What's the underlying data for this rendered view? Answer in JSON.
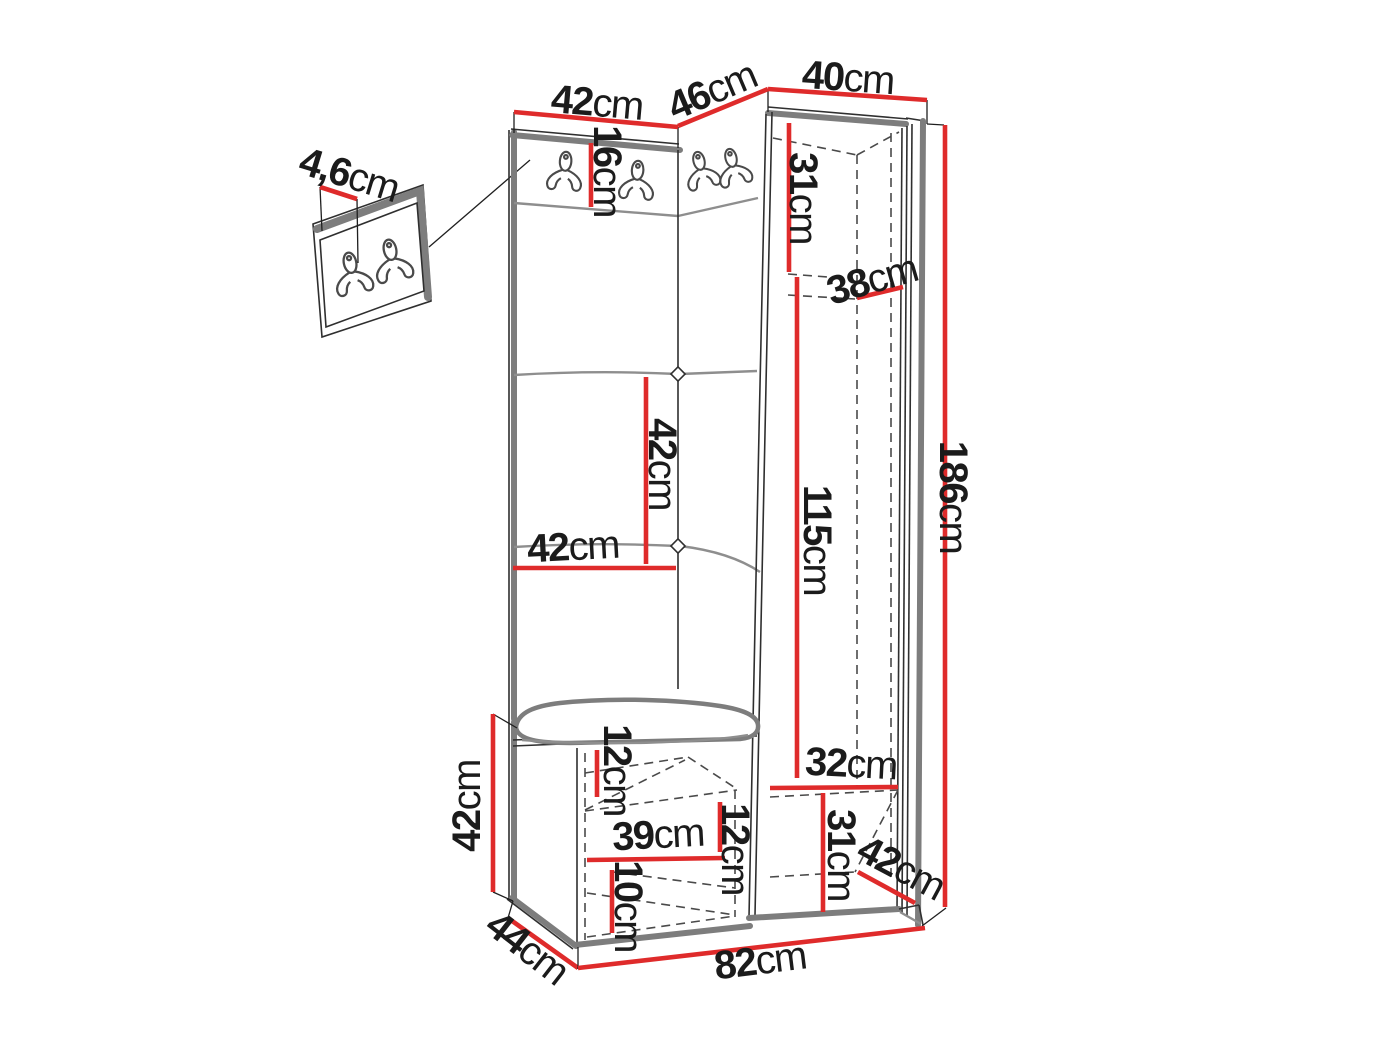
{
  "figure": {
    "type": "hallway-furniture-dimension-diagram",
    "unit": "cm",
    "colors": {
      "dimension_line": "#df2b2b",
      "outline_gray": "#7d7d7d",
      "label_text": "#1b1b1b"
    },
    "icons": {
      "coat_hook": "double-coat-hook-icon"
    },
    "dimensions": {
      "wall_panel_thickness": {
        "value": "4,6",
        "unit": "cm"
      },
      "left_panel_width_top": {
        "value": "42",
        "unit": "cm"
      },
      "corner_section_width": {
        "value": "46",
        "unit": "cm"
      },
      "wardrobe_width": {
        "value": "40",
        "unit": "cm"
      },
      "hook_strip_height": {
        "value": "16",
        "unit": "cm"
      },
      "wardrobe_top_compartment_height": {
        "value": "31",
        "unit": "cm"
      },
      "wardrobe_shelf_depth": {
        "value": "38",
        "unit": "cm"
      },
      "total_height": {
        "value": "186",
        "unit": "cm"
      },
      "panel_tile_height": {
        "value": "42",
        "unit": "cm"
      },
      "panel_width": {
        "value": "42",
        "unit": "cm"
      },
      "hanging_space_height": {
        "value": "115",
        "unit": "cm"
      },
      "bench_height": {
        "value": "42",
        "unit": "cm"
      },
      "bench_top_clearance": {
        "value": "12",
        "unit": "cm"
      },
      "bench_shelf_width": {
        "value": "39",
        "unit": "cm"
      },
      "bench_shelf_spacing": {
        "value": "12",
        "unit": "cm"
      },
      "bench_base_height": {
        "value": "10",
        "unit": "cm"
      },
      "wardrobe_bottom_width": {
        "value": "32",
        "unit": "cm"
      },
      "wardrobe_bottom_height": {
        "value": "31",
        "unit": "cm"
      },
      "wardrobe_bottom_depth": {
        "value": "42",
        "unit": "cm"
      },
      "bench_depth": {
        "value": "44",
        "unit": "cm"
      },
      "total_width": {
        "value": "82",
        "unit": "cm"
      }
    }
  }
}
